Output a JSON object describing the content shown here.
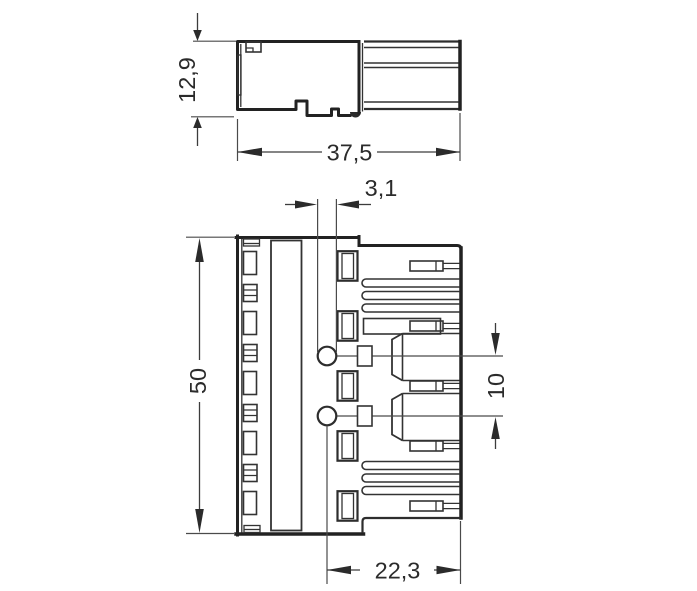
{
  "drawing": {
    "background": "#ffffff",
    "line_color": "#2b2b2b",
    "contact_color": "#f0ad74",
    "dimensions": {
      "side_height": "12,9",
      "side_width": "37,5",
      "hole_diameter": "3,1",
      "front_height": "50",
      "pin_spacing": "10",
      "plug_width": "22,3"
    }
  }
}
